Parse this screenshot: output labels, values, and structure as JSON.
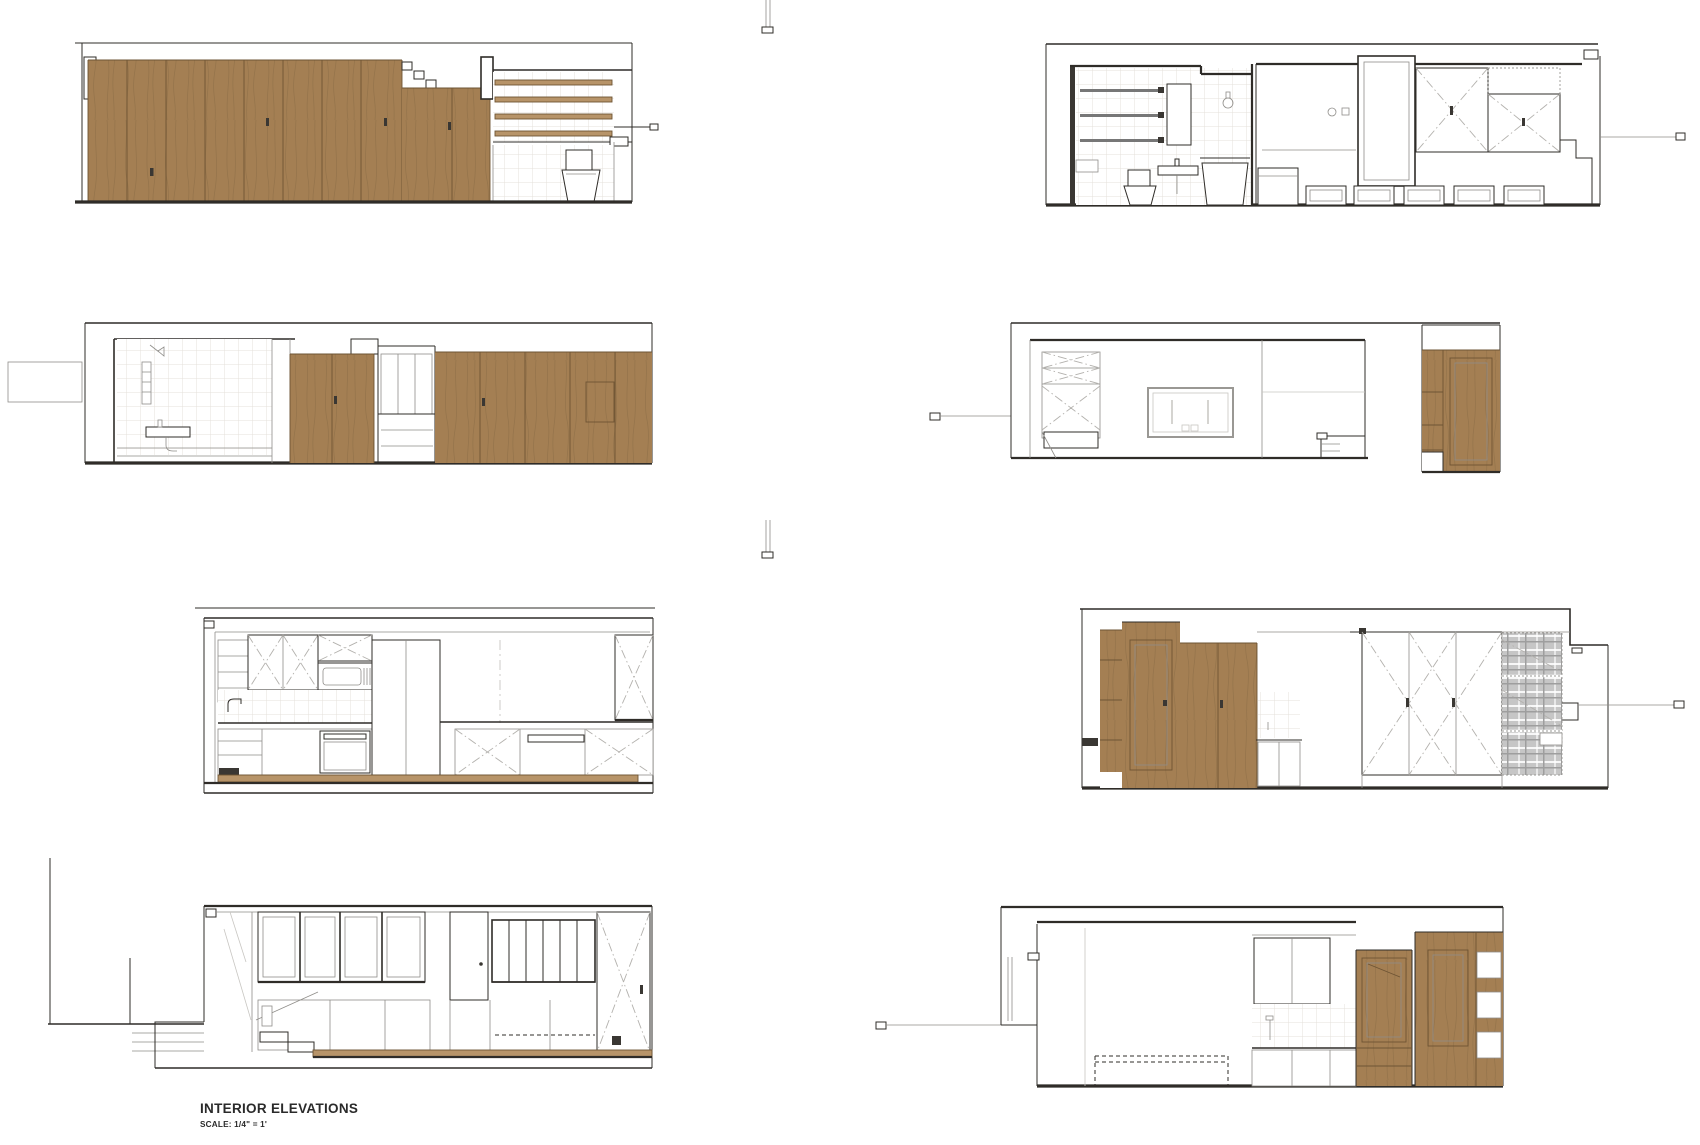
{
  "sheet": {
    "width_px": 1700,
    "height_px": 1145,
    "background": "#ffffff"
  },
  "title_block": {
    "title": "INTERIOR ELEVATIONS",
    "scale_note": "SCALE: 1/4\" = 1'"
  },
  "colors": {
    "line_dark": "#2f2c28",
    "line_mid": "#8f8d89",
    "line_light": "#c8c6c2",
    "wood": "#a47f53",
    "wood_light": "#b79469",
    "wood_seam": "#6e5434",
    "tile_line": "#e4e1db",
    "hatch": "#cbcbcb",
    "plaid": "#c6c6c6",
    "paper": "#ffffff"
  },
  "panels": [
    {
      "id": "elevation-1",
      "name": "wood-partition-wall",
      "description": "full-height wood panel wall with loft stair slats and toilet alcove"
    },
    {
      "id": "elevation-2",
      "name": "bathroom-and-bed-wall",
      "description": "tiled bathroom with fixtures, tall door frame, mirrored wardrobe and under-bed drawers"
    },
    {
      "id": "elevation-3",
      "name": "shower-and-wood-doors",
      "description": "tiled shower room, pass-through opening and wood sliding doors"
    },
    {
      "id": "elevation-4",
      "name": "media-wall",
      "description": "white wall with wall-mounted frame, shelving unit and freestanding wood cabinet"
    },
    {
      "id": "elevation-5",
      "name": "kitchen-wall",
      "description": "kitchen elevation with upper cabinets, microwave, backsplash and base cabinets"
    },
    {
      "id": "elevation-6",
      "name": "wardrobe-and-bed-nook",
      "description": "wood cabinet doors, kitchenette, crossed wardrobe doors and plaid bed nook"
    },
    {
      "id": "elevation-7",
      "name": "window-wall-entry",
      "description": "clerestory window wall with door, exterior stair and millwork below"
    },
    {
      "id": "elevation-8",
      "name": "bed-and-kitchenette-wall",
      "description": "white wall with dashed bed outline, kitchenette, framed wood cabinets and shelves"
    }
  ]
}
